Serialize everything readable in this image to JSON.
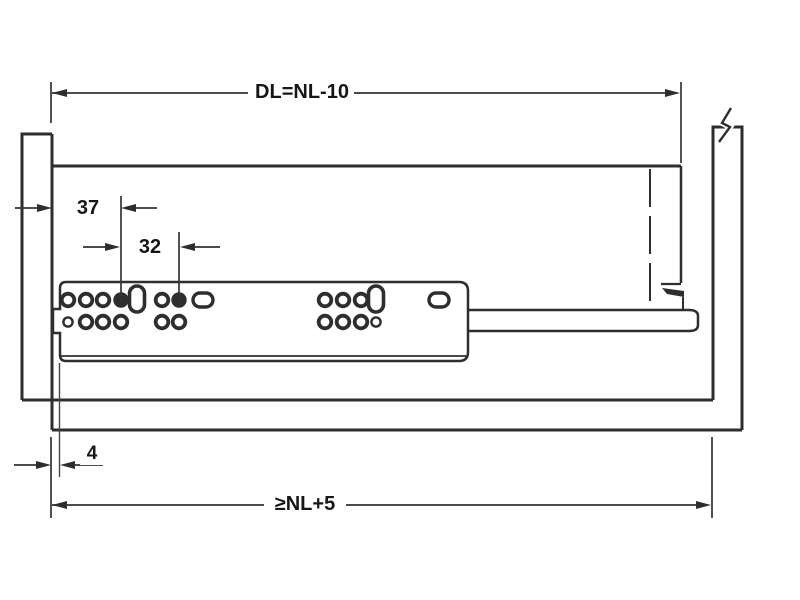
{
  "diagram": {
    "labels": {
      "top_dimension": "DL=NL-10",
      "bottom_dimension": "≥NL+5",
      "front_offset": "37",
      "hole_pitch": "32",
      "gap": "4"
    },
    "line_color": "#2e2e2e",
    "holes": {
      "rings": [
        [
          68,
          300
        ],
        [
          86,
          300
        ],
        [
          103,
          300
        ],
        [
          162,
          300
        ],
        [
          86,
          322
        ],
        [
          103,
          322
        ],
        [
          121,
          322
        ],
        [
          162,
          322
        ],
        [
          179,
          322
        ],
        [
          325,
          300
        ],
        [
          343,
          300
        ],
        [
          361,
          300
        ],
        [
          325,
          322
        ],
        [
          343,
          322
        ],
        [
          361,
          322
        ]
      ],
      "filled": [
        [
          121,
          300
        ],
        [
          179,
          300
        ]
      ],
      "small": [
        [
          68,
          322
        ],
        [
          376,
          322
        ]
      ],
      "slots_v": [
        [
          137,
          299
        ],
        [
          376,
          299
        ]
      ],
      "slots_h": [
        [
          203,
          300
        ],
        [
          439,
          300
        ]
      ]
    }
  }
}
